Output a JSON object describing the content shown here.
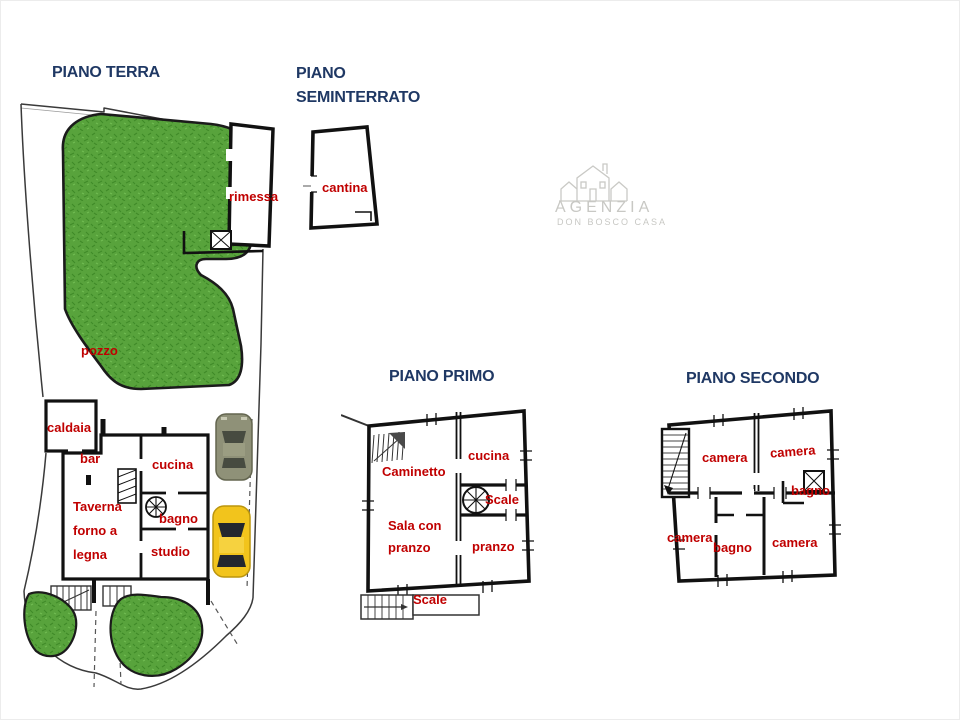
{
  "titles": {
    "terra": "PIANO TERRA",
    "seminterrato": "PIANO SEMINTERRATO",
    "primo": "PIANO PRIMO",
    "secondo": "PIANO SECONDO"
  },
  "rooms": {
    "terra": {
      "rimessa": "rimessa",
      "pozzo": "pozzo",
      "caldaia": "caldaia",
      "bar": "bar",
      "cucina": "cucina",
      "taverna": "Taverna forno a legna",
      "bagno": "bagno",
      "studio": "studio"
    },
    "seminterrato": {
      "cantina": "cantina"
    },
    "primo": {
      "caminetto": "Caminetto",
      "cucina": "cucina",
      "scale_upper": "Scale",
      "sala_con_pranzo": "Sala con pranzo",
      "pranzo": "pranzo",
      "scale_lower": "Scale"
    },
    "secondo": {
      "camera_top_left": "camera",
      "camera_top_right": "camera",
      "bagno_right": "bagno",
      "camera_bottom_left": "camera",
      "bagno_bottom": "bagno",
      "camera_bottom_right": "camera"
    }
  },
  "watermark": {
    "agency": "AGENZIA",
    "subtitle": "DON BOSCO CASA"
  },
  "colors": {
    "floor_title": "#1f3864",
    "room_label": "#c00000",
    "grass": "#58a33c",
    "walls": "#111111",
    "watermark": "#c8c8c4",
    "car_gray": "#8f9178",
    "car_yellow": "#f2c41c"
  },
  "icons": {
    "gray_car": "car-top-view",
    "yellow_car": "car-top-view",
    "spiral_stairs": "spiral-staircase",
    "watermark_logo": "houses-line-art"
  }
}
